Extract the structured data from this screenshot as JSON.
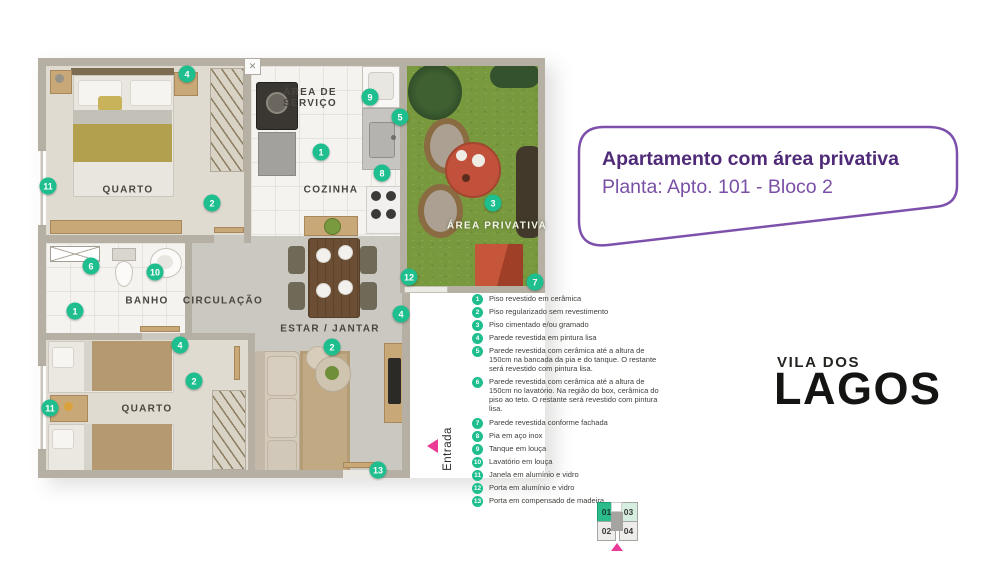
{
  "header": {
    "title": "Apartamento com área privativa",
    "subtitle": "Planta: Apto. 101 - Bloco 2"
  },
  "brand": {
    "top": "VILA DOS",
    "bottom": "LAGOS"
  },
  "colors": {
    "accent_teal": "#1EBE8E",
    "brand_purple": "#9633DD",
    "brand_pink": "#F74FA2",
    "title_purple": "#4F2A78",
    "entrance_pink": "#EA3A96"
  },
  "plan": {
    "entrance": "Entrada",
    "labels": {
      "bedroom1": "QUARTO",
      "service": "ÁREA DE SERVIÇO",
      "kitchen": "COZINHA",
      "bath": "BANHO",
      "hall": "CIRCULAÇÃO",
      "living": "ESTAR / JANTAR",
      "bedroom2": "QUARTO",
      "garden": "ÁREA PRIVATIVA"
    },
    "markers": [
      {
        "n": "4",
        "x": 149,
        "y": 16
      },
      {
        "n": "9",
        "x": 332,
        "y": 39
      },
      {
        "n": "5",
        "x": 362,
        "y": 59
      },
      {
        "n": "1",
        "x": 283,
        "y": 94
      },
      {
        "n": "8",
        "x": 344,
        "y": 115
      },
      {
        "n": "11",
        "x": 10,
        "y": 128
      },
      {
        "n": "2",
        "x": 174,
        "y": 145
      },
      {
        "n": "3",
        "x": 455,
        "y": 145
      },
      {
        "n": "6",
        "x": 53,
        "y": 208
      },
      {
        "n": "10",
        "x": 117,
        "y": 214
      },
      {
        "n": "12",
        "x": 371,
        "y": 219
      },
      {
        "n": "7",
        "x": 497,
        "y": 224
      },
      {
        "n": "1",
        "x": 37,
        "y": 253
      },
      {
        "n": "4",
        "x": 363,
        "y": 256
      },
      {
        "n": "4",
        "x": 142,
        "y": 287
      },
      {
        "n": "2",
        "x": 294,
        "y": 289
      },
      {
        "n": "2",
        "x": 156,
        "y": 323
      },
      {
        "n": "11",
        "x": 12,
        "y": 350
      },
      {
        "n": "13",
        "x": 340,
        "y": 412
      }
    ]
  },
  "legend": {
    "items": [
      {
        "num": "1",
        "text": "Piso revestido em cerâmica"
      },
      {
        "num": "2",
        "text": "Piso regularizado sem revestimento"
      },
      {
        "num": "3",
        "text": "Piso cimentado e/ou gramado"
      },
      {
        "num": "4",
        "text": "Parede revestida em pintura lisa"
      },
      {
        "num": "5",
        "text": "Parede revestida com cerâmica até a altura de 150cm na bancada da pia e do tanque. O restante será revestido com pintura lisa."
      },
      {
        "num": "6",
        "text": "Parede revestida com cerâmica até a altura de 150cm no lavatório. Na região do box, cerâmica do piso ao teto. O restante será revestido com pintura lisa."
      },
      {
        "num": "7",
        "text": "Parede revestida conforme fachada"
      },
      {
        "num": "8",
        "text": "Pia em aço inox"
      },
      {
        "num": "9",
        "text": "Tanque em louça"
      },
      {
        "num": "10",
        "text": "Lavatório em louça"
      },
      {
        "num": "11",
        "text": "Janela em alumínio e vidro"
      },
      {
        "num": "12",
        "text": "Porta em alumínio e vidro"
      },
      {
        "num": "13",
        "text": "Porta em compensado de madeira"
      }
    ]
  },
  "unit_map": {
    "cells": [
      {
        "label": "01",
        "state": "active"
      },
      {
        "label": "03",
        "state": "soft"
      },
      {
        "label": "02",
        "state": "default"
      },
      {
        "label": "04",
        "state": "default"
      }
    ]
  }
}
